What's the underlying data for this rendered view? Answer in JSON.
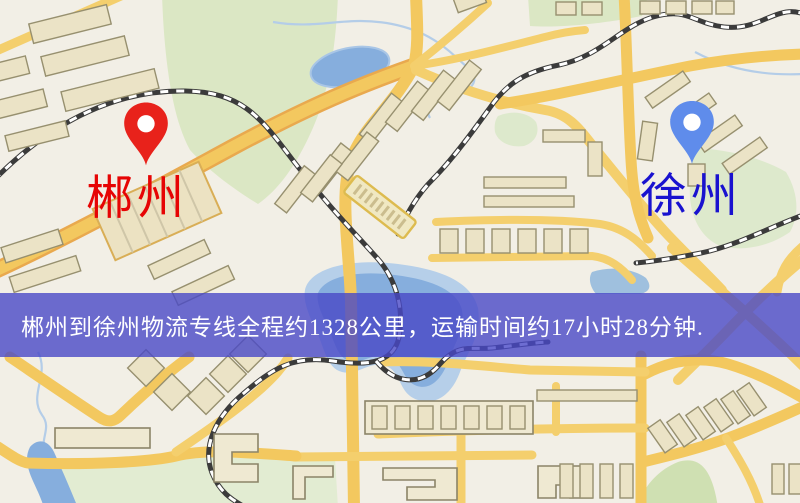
{
  "map": {
    "origin_marker": {
      "label": "郴州"
    },
    "destination_marker": {
      "label": "徐州"
    },
    "banner": {
      "text": "郴州到徐州物流专线全程约1328公里，运输时间约17小时28分钟.",
      "route": "郴州到徐州物流专线",
      "distance_text": "约1328公里",
      "duration_text": "约17小时28分钟"
    }
  },
  "icons": {
    "origin_pin": "map-pin",
    "destination_pin": "map-pin"
  },
  "colors": {
    "origin_pin": "#e8221b",
    "origin_label": "#e60404",
    "destination_pin": "#5f8ceb",
    "destination_label": "#1912cf",
    "banner_background": "#4848c7",
    "banner_text": "#ffffff",
    "map_background": "#f2efe6",
    "road": "#f4cf6d",
    "park": "#dbe7c4",
    "water": "#86aedd",
    "railway": "#3b3b3b",
    "building": "#ebe3c6"
  }
}
